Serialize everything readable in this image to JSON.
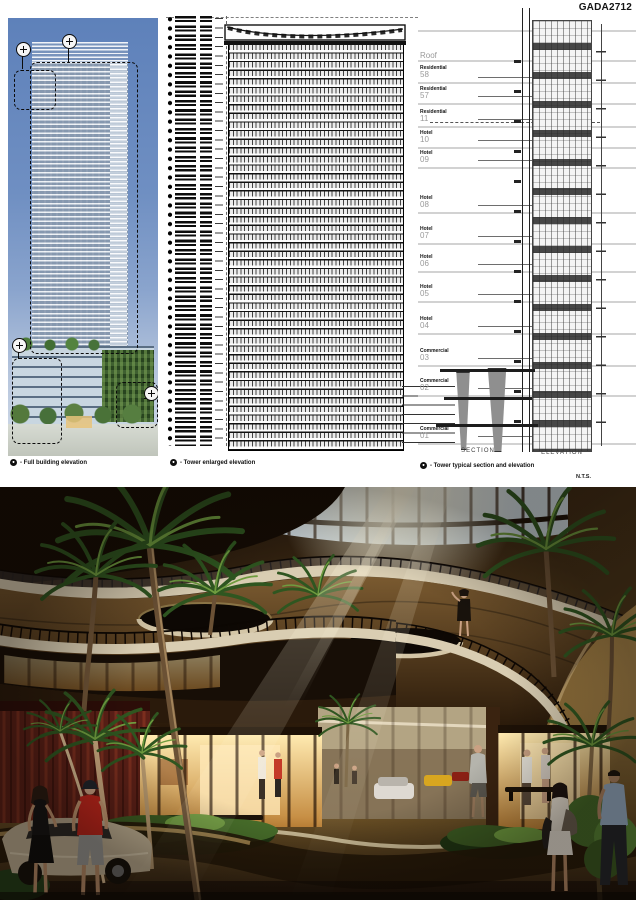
{
  "board": {
    "code": "GADA2712",
    "scale_note": "N.T.S.",
    "captions": [
      {
        "label": "- Full building elevation"
      },
      {
        "label": "- Tower enlarged elevation"
      },
      {
        "label": "- Tower typical section and elevation"
      }
    ]
  },
  "section_drawing": {
    "section_label": "SECTION",
    "elevation_label": "ELEVATION",
    "labels": [
      {
        "type": "",
        "num": "Roof"
      },
      {
        "type": "Residential",
        "num": "58"
      },
      {
        "type": "Residential",
        "num": "57"
      },
      {
        "type": "Residential",
        "num": "11"
      },
      {
        "type": "Hotel",
        "num": "10"
      },
      {
        "type": "Hotel",
        "num": "09"
      },
      {
        "type": "Hotel",
        "num": "08"
      },
      {
        "type": "Hotel",
        "num": "07"
      },
      {
        "type": "Hotel",
        "num": "06"
      },
      {
        "type": "Hotel",
        "num": "05"
      },
      {
        "type": "Hotel",
        "num": "04"
      },
      {
        "type": "Commercial",
        "num": "03"
      },
      {
        "type": "Commercial",
        "num": "02"
      },
      {
        "type": "Commercial",
        "num": "01"
      }
    ]
  },
  "colors": {
    "sky_blue": "#6c8cbe",
    "drawing_ink": "#1a1a1a",
    "floor_line_gray": "#d2d2d2",
    "label_gray": "#9a9a9a",
    "render_wood": "#5d4526",
    "render_cream": "#d9cdb2",
    "render_glow": "#ffd98f",
    "render_red_wall": "#5c2017",
    "palm_green": "#3a6526"
  }
}
